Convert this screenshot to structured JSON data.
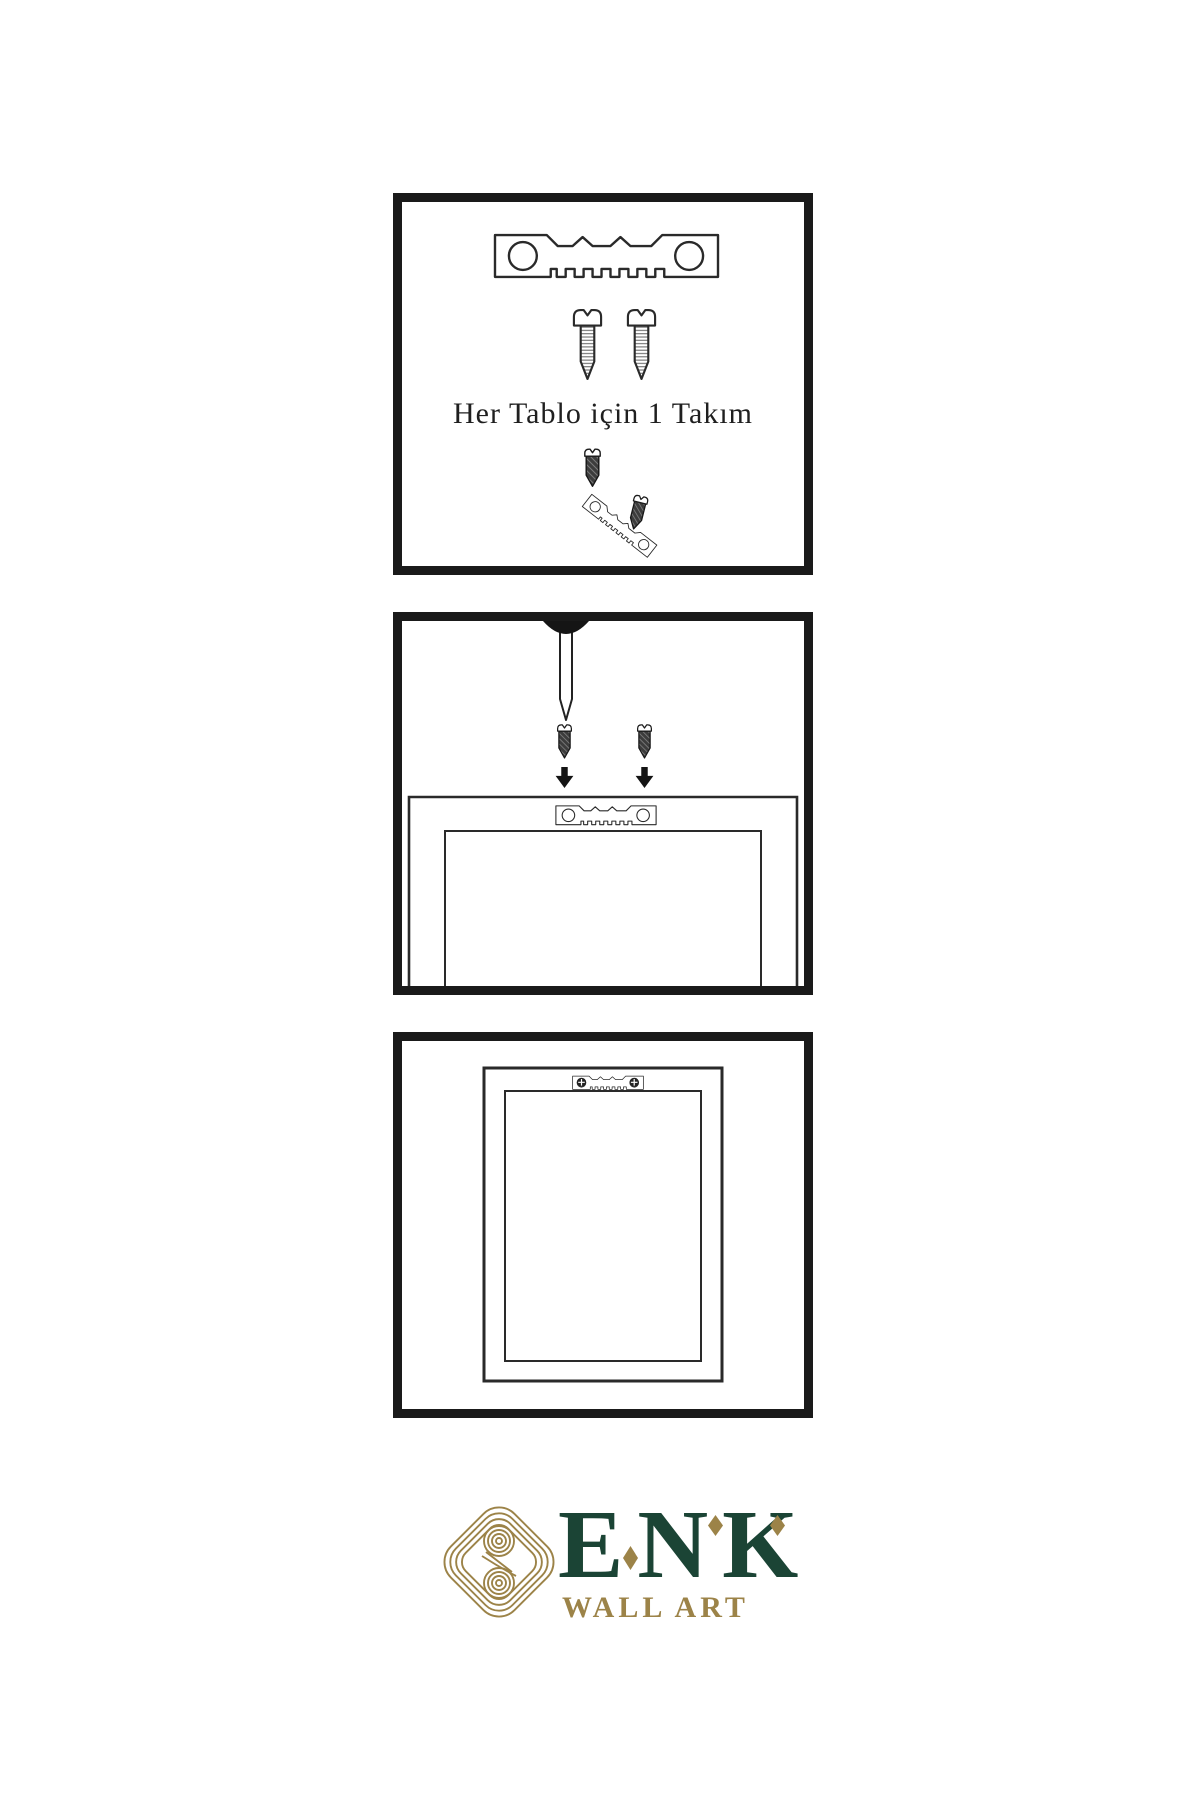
{
  "instructions": {
    "step1": {
      "name": "hardware-kit",
      "caption": "Her Tablo için 1 Takım",
      "icons": [
        "sawtooth-hanger-icon",
        "screw-icon",
        "screw-icon",
        "screw-driving-icon",
        "tilted-hanger-icon",
        "screw-icon"
      ]
    },
    "step2": {
      "name": "attach-hanger-to-frame",
      "icons": [
        "nail-icon",
        "screw-icon",
        "screw-icon",
        "down-arrow-icon",
        "down-arrow-icon",
        "frame-back-top-icon",
        "sawtooth-hanger-icon"
      ]
    },
    "step3": {
      "name": "frame-hung-on-wall",
      "icons": [
        "frame-back-icon",
        "mounted-sawtooth-hanger-icon",
        "mounted-screw-icon",
        "mounted-screw-icon"
      ]
    }
  },
  "brand": {
    "name": "ENK",
    "subtitle": "WALL ART",
    "icon": "knot-icon",
    "colors": {
      "green": "#1b4435",
      "gold": "#9c8348"
    }
  },
  "colors": {
    "panel_border": "#1a1a1a",
    "line": "#2a2a2a",
    "ink": "#1f1f1f",
    "background": "#ffffff"
  }
}
